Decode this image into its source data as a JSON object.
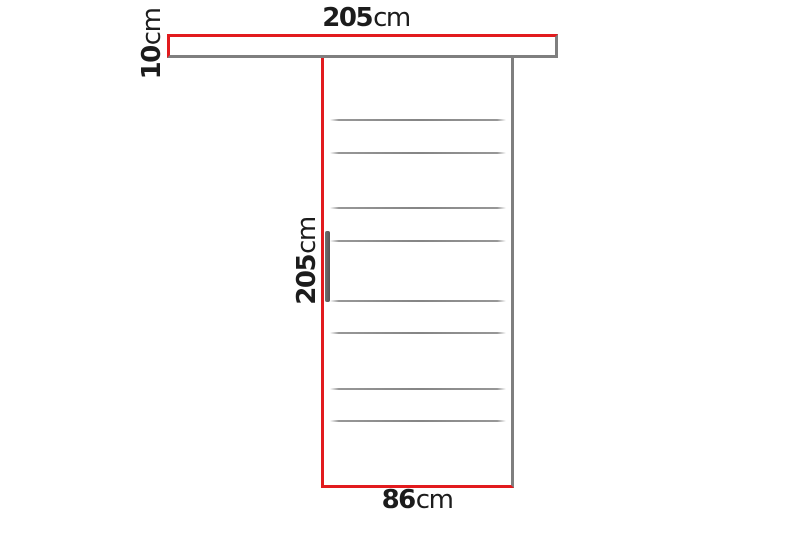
{
  "dimensions": {
    "rail_width": {
      "value": "205",
      "unit": "cm"
    },
    "rail_thickness": {
      "value": "10",
      "unit": "cm"
    },
    "door_height": {
      "value": "205",
      "unit": "cm"
    },
    "door_width": {
      "value": "86",
      "unit": "cm"
    }
  },
  "door": {
    "groove_line_count": 8,
    "has_handle": true
  },
  "colors": {
    "dimension_red": "#e21b1e",
    "outline_gray": "#7f7f7f",
    "groove_gray": "#858585",
    "handle_gray": "#565656",
    "text_color": "#1c1c1c",
    "background": "#ffffff"
  }
}
